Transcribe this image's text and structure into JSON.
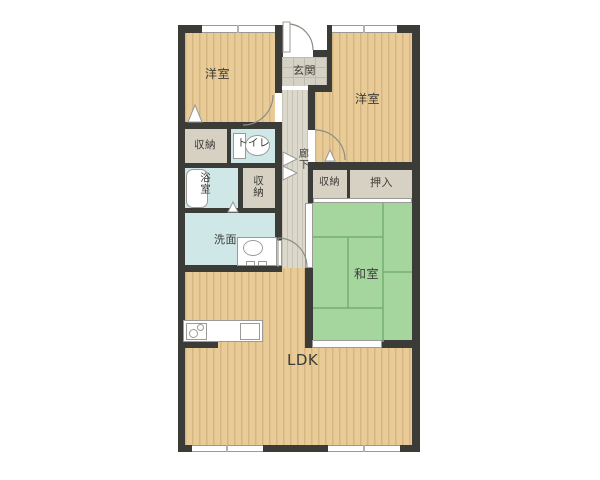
{
  "plan": {
    "type": "apartment-floor-plan",
    "rooms": {
      "western1": {
        "label": "洋室"
      },
      "western2": {
        "label": "洋室"
      },
      "entrance": {
        "label": "玄関"
      },
      "corridor": {
        "label": "廊下"
      },
      "storage1": {
        "label": "収納"
      },
      "toilet": {
        "label": "トイレ"
      },
      "bathroom": {
        "label": "浴室"
      },
      "storage2": {
        "label": "収納"
      },
      "storage3": {
        "label": "収納"
      },
      "closet": {
        "label": "押入"
      },
      "washroom": {
        "label": "洗面"
      },
      "japanese": {
        "label": "和室"
      },
      "ldk": {
        "label": "LDK"
      }
    },
    "colors": {
      "wall": "#3b3b38",
      "wood_floor": "#e9cb97",
      "wood_stripe": "#d6b680",
      "tatami_green": "#a4d69e",
      "tatami_line": "#74ae74",
      "wet_area_blue": "#cfe7e6",
      "storage_beige": "#d6d1c3",
      "hall_gray": "#dcd8cb",
      "label_text": "#3c3c38",
      "background": "#ffffff"
    }
  }
}
